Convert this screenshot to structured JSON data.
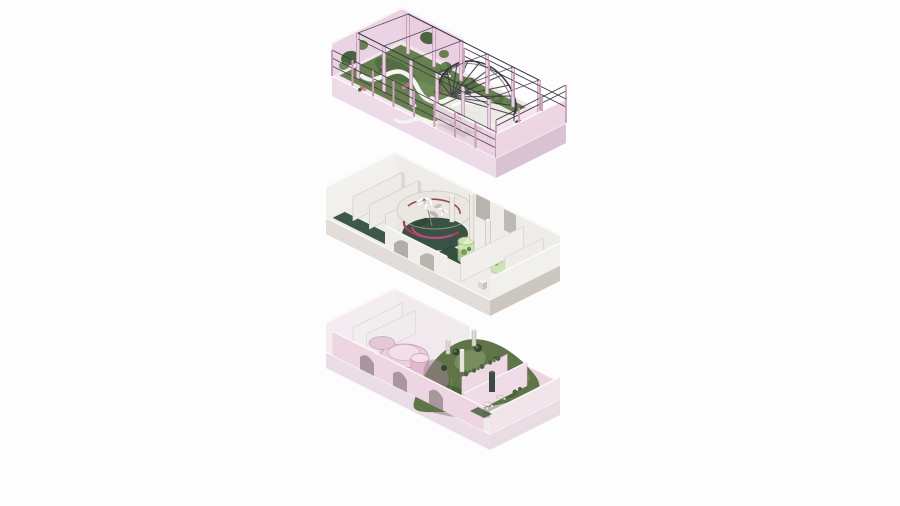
{
  "figure": {
    "type": "exploded-axonometric-architectural-visualization",
    "level_count": 3,
    "background": "#fdfdfd"
  },
  "levels": [
    {
      "id": "roof-garden-terrace",
      "position": "top",
      "features": [
        "pink-parapet-railings",
        "ivy-walls",
        "pergola-column-grid",
        "ribbed-arch-canopy",
        "serpentine-path",
        "garden-planting",
        "flowering-shrubs",
        "bistro-tables"
      ]
    },
    {
      "id": "middle-interior-floor",
      "position": "center",
      "features": [
        "white-partition-rooms",
        "dark-green-floor-strips",
        "circular-atrium",
        "spiral-ramp",
        "orchid-sculpture",
        "glass-planter-cylinders",
        "white-columns",
        "arched-openings"
      ]
    },
    {
      "id": "ground-garden-floor",
      "position": "bottom",
      "features": [
        "arched-pink-walls",
        "white-rooms",
        "circular-terraces",
        "pink-kiosk-cylinder",
        "planted-mound",
        "cafe-tables",
        "pink-partition-rooms"
      ]
    }
  ],
  "palette": {
    "bg": "#fdfdfd",
    "pink_deck": "#f2e3ec",
    "pink_light": "#f5e8f0",
    "pink_mid": "#ead3e2",
    "pink_panel": "#e9cfdf",
    "pink_wall": "#eed5e2",
    "pink_fascia": "#eddbe7",
    "pink_fascia_side": "#d9c2d2",
    "mauve_edge": "#a87c9c",
    "post_pink": "#c99fb6",
    "white_wall": "#f2f0ed",
    "white_shade": "#dcd7d2",
    "gray_shadow": "#b3ada7",
    "slab_side": "#cdc7c1",
    "green_garden": "#66804f",
    "green_dark": "#4a6440",
    "green_deep": "#2e4a3a",
    "green_bright": "#7d9a63",
    "green_glass": "#c8e0a8",
    "green_glass_edge": "#9ab87e",
    "green_mound": "#5f7548",
    "green_mound_dark": "#3c5232",
    "green_mound_light": "#8ba06b",
    "mauve_patch": "#a37f93",
    "magenta": "#a23d62",
    "rib_dark": "#3a3740",
    "table_teal": "#3d525c",
    "flower_pink": "#c06a86",
    "trunk_brown": "#5a4a42",
    "white_cap": "#ffffff"
  }
}
